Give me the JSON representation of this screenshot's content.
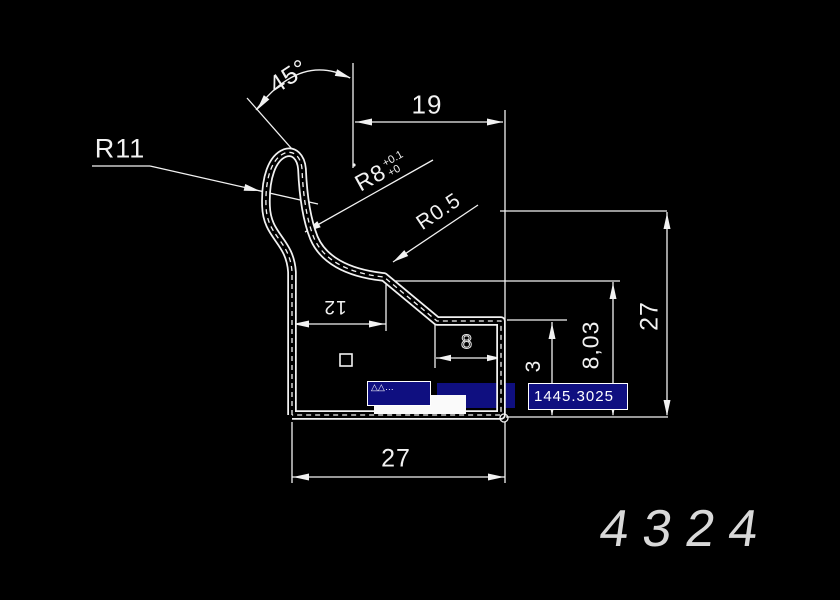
{
  "app": {
    "background": "#000000",
    "line_color": "#ffffff",
    "highlight_fill": "#0f0f80",
    "highlight_border": "#ffffff"
  },
  "annotations": {
    "radius_r11": "R11",
    "angle_45": "45°",
    "dim_19": "19",
    "r8_main": "R8",
    "r8_tol_upper": "+0.1",
    "r8_tol_lower": "+0",
    "radius_r05": "R0.5",
    "dim_12": "12",
    "dim_notch": "8",
    "dim_3": "3",
    "dim_8_03": "8,03",
    "dim_27_right": "27",
    "dim_27_bottom": "27"
  },
  "overlays": {
    "coordinate_readout": "1445.3025",
    "command_glyphs": "△△…"
  },
  "title_block": {
    "part_number": "4324"
  }
}
